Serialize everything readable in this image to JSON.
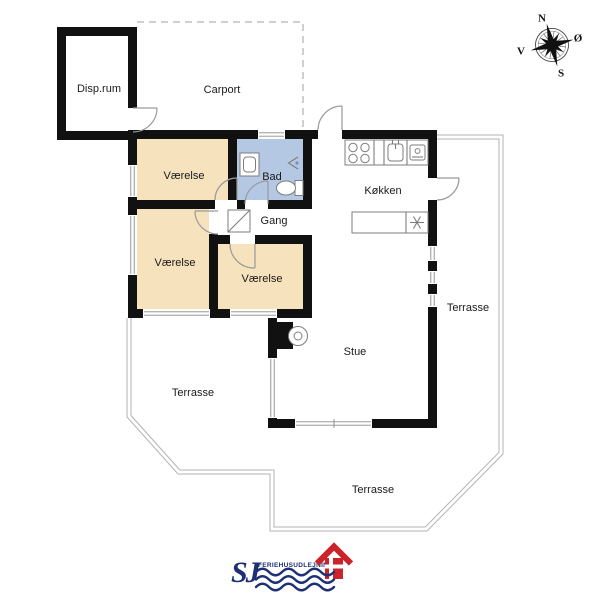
{
  "plan": {
    "rooms": {
      "disp_rum": {
        "label": "Disp.rum"
      },
      "carport": {
        "label": "Carport"
      },
      "vaerelse_1": {
        "label": "Værelse"
      },
      "vaerelse_2": {
        "label": "Værelse"
      },
      "vaerelse_3": {
        "label": "Værelse"
      },
      "bad": {
        "label": "Bad"
      },
      "gang": {
        "label": "Gang"
      },
      "koekken": {
        "label": "Køkken"
      },
      "stue": {
        "label": "Stue"
      },
      "terrasse_right": {
        "label": "Terrasse"
      },
      "terrasse_left": {
        "label": "Terrasse"
      },
      "terrasse_bottom": {
        "label": "Terrasse"
      }
    },
    "compass": {
      "north": "N",
      "east": "Ø",
      "south": "S",
      "west": "V"
    },
    "logo": {
      "initials": "SJ",
      "name": "FERIEHUSUDLEJNING"
    },
    "colors": {
      "wall": "#111111",
      "bedroom_fill": "#f6e3bd",
      "bath_fill": "#b4c7e3",
      "logo_navy": "#1d3076",
      "logo_red": "#cc2229",
      "terrace_outline": "#b3b3b3"
    }
  }
}
